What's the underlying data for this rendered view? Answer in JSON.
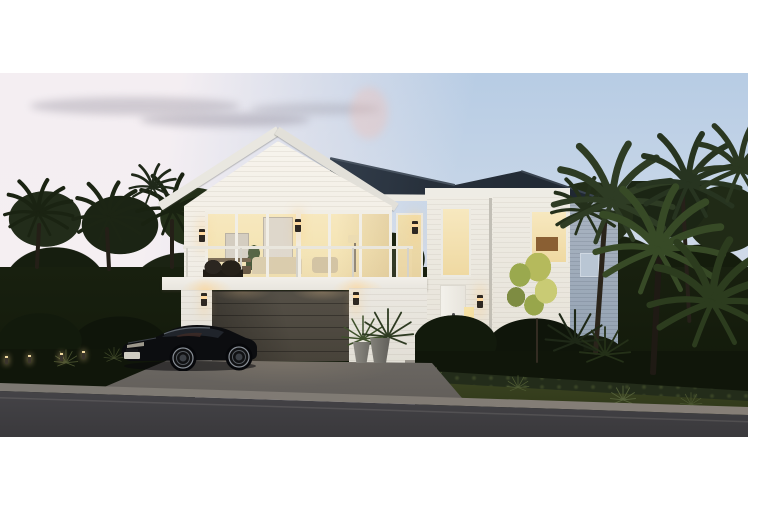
{
  "meta": {
    "domain": "real-estate-architectural-render",
    "time_of_day": "dusk",
    "aria_label": "Dusk render of a two-storey white weatherboard home with front gable, glass balcony, double garage and lit interior, surrounded by palms and tropical planting, with a black coupe parked on the driveway beside a street"
  },
  "scene": {
    "house": {
      "storeys": 2,
      "cladding": "white weatherboard and brick",
      "roof": "charcoal hip roof with front gable",
      "features": [
        "floor-to-ceiling glazing",
        "glass balustrade balcony",
        "double garage door",
        "front door with lit sidelight",
        "up-down wall sconces"
      ]
    },
    "vehicle": {
      "type": "black coupe",
      "position": "parked on driveway in front of garage"
    },
    "vegetation": [
      "palm trees",
      "cabbage trees",
      "clipped hedge",
      "yellow-green feature tree",
      "grass berm",
      "potted plants"
    ],
    "street": "asphalt road with concrete kerb and garden bollard lights"
  },
  "colors": {
    "sky-blue": "#b7cce4",
    "sky-pink": "#ece3e8",
    "roof": "#27303b",
    "clad": "#f0ebe1",
    "clad-shadow": "#93a2b2",
    "glaze": "#f7e8bf",
    "garage": "#48433a",
    "veg-dark": "#18200f",
    "veg-light": "#55683a",
    "drive": "#615d59",
    "road": "#3a393c",
    "kerb": "#867f77",
    "car": "#0c0d10",
    "glow": "#ffd9a0"
  }
}
